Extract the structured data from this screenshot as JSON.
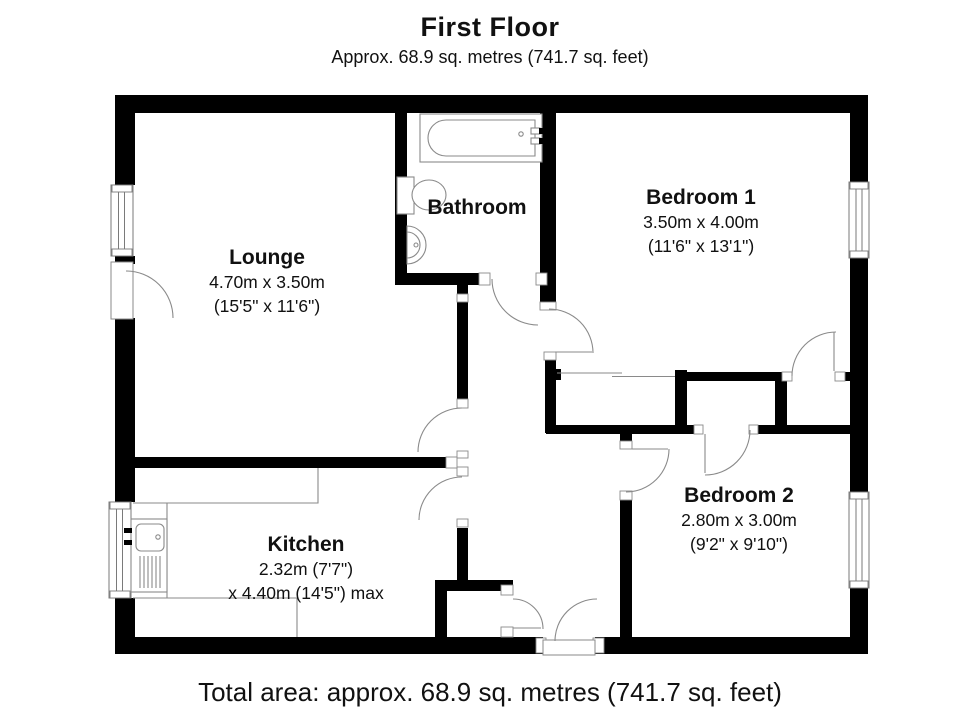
{
  "title": "First Floor",
  "subtitle": "Approx. 68.9 sq. metres (741.7 sq. feet)",
  "total_area": "Total area: approx. 68.9 sq. metres (741.7 sq. feet)",
  "rooms": {
    "lounge": {
      "name": "Lounge",
      "metric": "4.70m x 3.50m",
      "imperial": "(15'5\" x 11'6\")"
    },
    "bathroom": {
      "name": "Bathroom"
    },
    "bedroom1": {
      "name": "Bedroom 1",
      "metric": "3.50m x 4.00m",
      "imperial": "(11'6\" x 13'1\")"
    },
    "kitchen": {
      "name": "Kitchen",
      "metric": "2.32m (7'7\")",
      "imperial": "x 4.40m (14'5\") max"
    },
    "bedroom2": {
      "name": "Bedroom 2",
      "metric": "2.80m x 3.00m",
      "imperial": "(9'2\" x 9'10\")"
    }
  },
  "colors": {
    "wall": "#000000",
    "fixture_line": "#8a8a8a",
    "text": "#111111"
  }
}
